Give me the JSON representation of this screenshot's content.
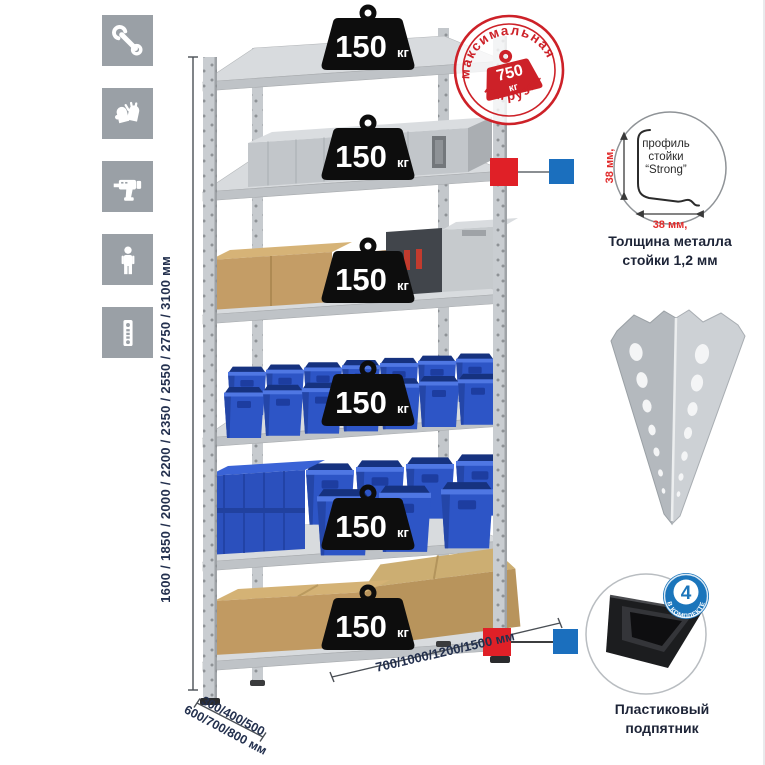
{
  "colors": {
    "stamp_red": "#cd2128",
    "marker_red": "#e02027",
    "marker_blue": "#1b6fbe",
    "bin_blue": "#2d55c6",
    "navy_text": "#23304e",
    "icon_gray": "#9aa0a6"
  },
  "left_icons": [
    {
      "name": "wrench-icon"
    },
    {
      "name": "gloves-icon"
    },
    {
      "name": "drill-icon"
    },
    {
      "name": "person-icon"
    },
    {
      "name": "rack-post-icon"
    }
  ],
  "dimensions": {
    "height_label": "1600 / 1850 / 2000 / 2200 / 2350 / 2550 / 2750 / 3100 мм",
    "width_label": "700/1000/1200/1500 мм",
    "depth_label_line1": "300/400/500",
    "depth_label_line2": "600/700/800 мм"
  },
  "shelf_badges": {
    "items": [
      {
        "value": "150",
        "unit": "кг"
      },
      {
        "value": "150",
        "unit": "кг"
      },
      {
        "value": "150",
        "unit": "кг"
      },
      {
        "value": "150",
        "unit": "кг"
      },
      {
        "value": "150",
        "unit": "кг"
      },
      {
        "value": "150",
        "unit": "кг"
      }
    ]
  },
  "stamp": {
    "arc_top": "максимальная",
    "arc_bottom": "нагрузка",
    "value": "750",
    "unit": "кг"
  },
  "profile_detail": {
    "lines": [
      "профиль",
      "стойки",
      "“Strong”"
    ],
    "dim_vertical": "38 мм,",
    "dim_horizontal": "38 мм,",
    "caption": "Толщина металла стойки 1,2 мм"
  },
  "foot_detail": {
    "badge_value": "4",
    "badge_arc": "В КОМПЛЕКТЕ",
    "caption": "Пластиковый подпятник"
  }
}
